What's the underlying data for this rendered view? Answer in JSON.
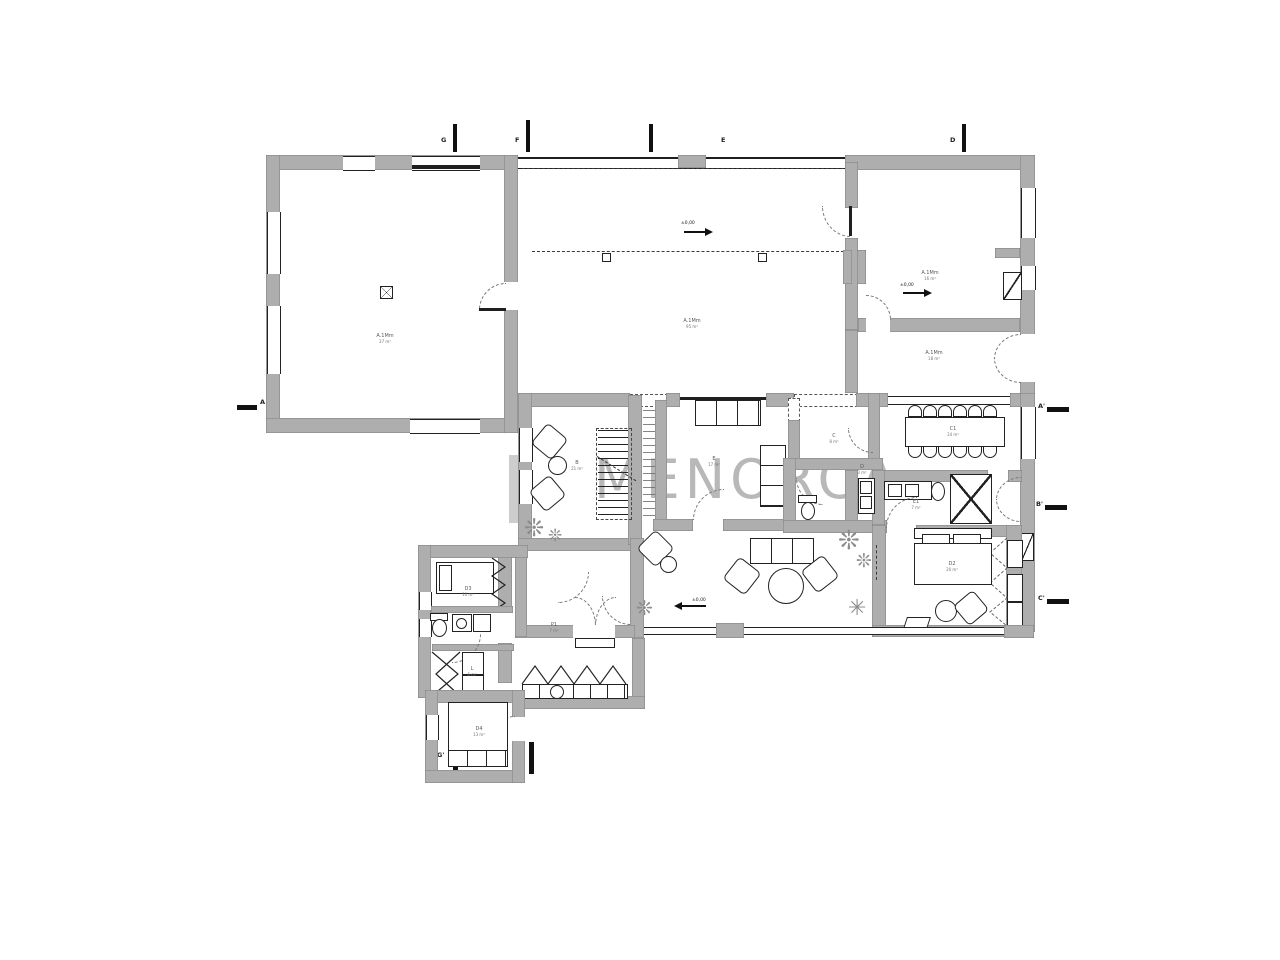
{
  "watermark": {
    "text": "MENORCA"
  },
  "colors": {
    "wall": "#aeaeae",
    "line": "#1f1f1f",
    "watermark": "#8e8e8e",
    "plant": "#8c8c8c"
  },
  "section_markers": {
    "top": [
      {
        "label": "G"
      },
      {
        "label": "F"
      },
      {
        "label": "E"
      },
      {
        "label": "D"
      }
    ],
    "bottom": [
      {
        "label": "G'"
      },
      {
        "label": "F'"
      }
    ],
    "left": [
      {
        "label": "A"
      }
    ],
    "right": [
      {
        "label": "A'"
      },
      {
        "label": "B'"
      },
      {
        "label": "C'"
      }
    ]
  },
  "levels": {
    "porch": "±0,00",
    "guest_room": "±0,00",
    "living": "±0,00"
  },
  "icons": {
    "plant": "❊",
    "star": "✳"
  },
  "rooms": [
    {
      "label": "A.1Mm",
      "area": "37 m²"
    },
    {
      "label": "A.1Mm",
      "area": "95 m²"
    },
    {
      "label": "A.1Mm",
      "area": "16 m²"
    },
    {
      "label": "A.1Mm",
      "area": "18 m²"
    },
    {
      "label": "B",
      "area": "21 m²"
    },
    {
      "label": "E",
      "area": "17 m²"
    },
    {
      "label": "C",
      "area": "8 m²"
    },
    {
      "label": "D",
      "area": "3 m²"
    },
    {
      "label": "C1",
      "area": "24 m²"
    },
    {
      "label": "E1",
      "area": "7 m²"
    },
    {
      "label": "D2",
      "area": "20 m²"
    },
    {
      "label": "D3",
      "area": "10 m²"
    },
    {
      "label": "P1",
      "area": "7 m²"
    },
    {
      "label": "L",
      "area": "6 m²"
    },
    {
      "label": "D4",
      "area": "13 m²"
    }
  ]
}
